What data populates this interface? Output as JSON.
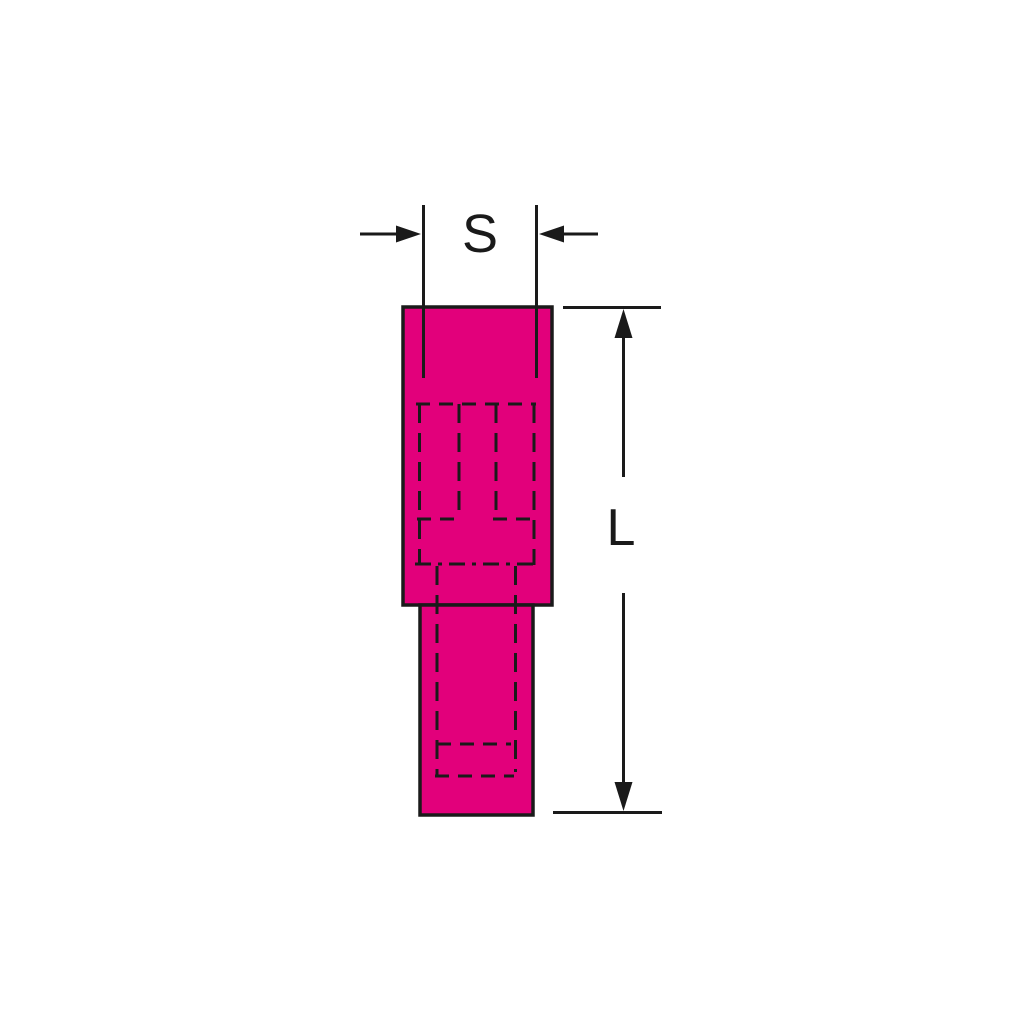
{
  "diagram": {
    "labels": {
      "width_dimension": "S",
      "length_dimension": "L"
    },
    "colors": {
      "terminal_fill": "#e2007b",
      "line": "#1a1a1a",
      "background": "#ffffff"
    }
  }
}
